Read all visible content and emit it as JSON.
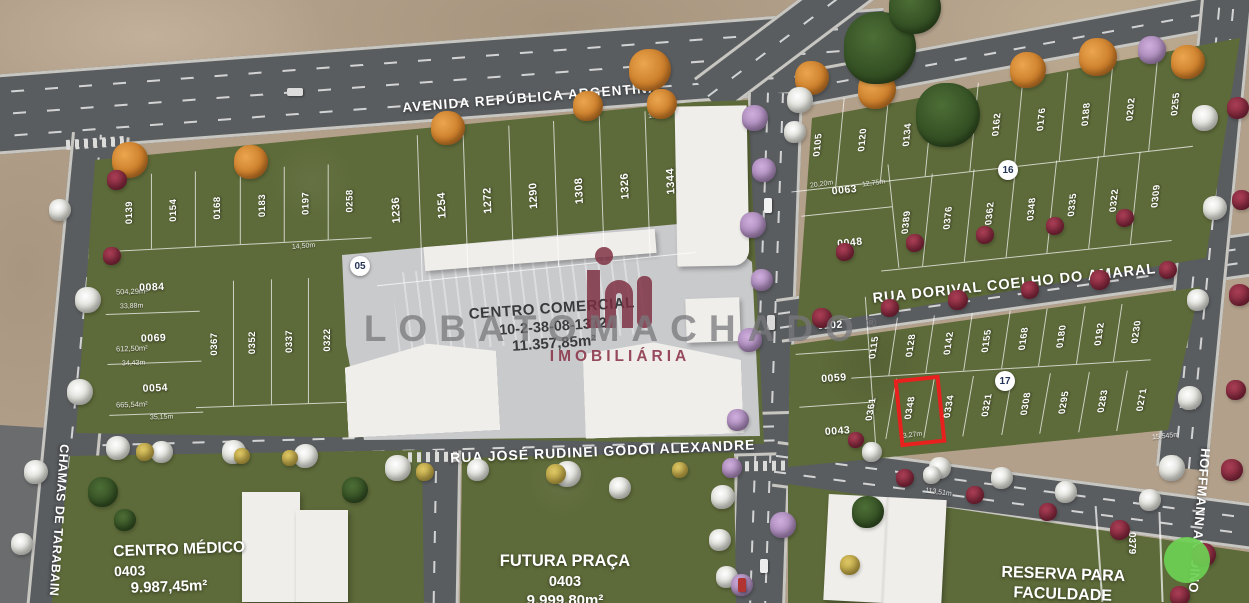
{
  "map": {
    "streets": {
      "avenida": "AVENIDA REPÚBLICA ARGENTINA",
      "rua_dorival": "RUA DORIVAL COELHO DO AMARAL",
      "rua_jose": "RUA JOSÉ RUDINEI GODOI ALEXANDRE",
      "rua_left_vertical": "CHAMAS DE TARABAIN",
      "rua_right_vertical": "HOFFMANN ANTOINO"
    },
    "markers": [
      "05",
      "16",
      "17"
    ],
    "areas": {
      "centro_comercial": {
        "title": "CENTRO COMERCIAL",
        "code": "10-2-38-08-1372",
        "area": "11.357,85m²"
      },
      "centro_medico": {
        "title": "CENTRO MÉDICO",
        "code": "0403",
        "area": "9.987,45m²"
      },
      "futura_praca": {
        "title": "FUTURA PRAÇA",
        "code": "0403",
        "area": "9.999,80m²"
      },
      "reserva_faculdade": {
        "title_line1": "RESERVA PARA",
        "title_line2": "FACULDADE"
      }
    },
    "lots": {
      "nw_top_row": [
        "0139",
        "0154",
        "0168",
        "0183",
        "0197",
        "0258"
      ],
      "avenue_row": [
        "1236",
        "1254",
        "1272",
        "1290",
        "1308",
        "1326",
        "1344"
      ],
      "west_column": [
        "0084",
        "0069",
        "0054"
      ],
      "west_inner_row": [
        "0367",
        "0352",
        "0337",
        "0322"
      ],
      "ne_top_row": [
        "0105",
        "0120",
        "0134",
        "0148",
        "0162",
        "0176",
        "0188",
        "0202",
        "0255"
      ],
      "ne_left_column": [
        "0063",
        "0048"
      ],
      "ne_bottom_row": [
        "0389",
        "0376",
        "0362",
        "0348",
        "0335",
        "0322",
        "0309"
      ],
      "se_left_column": [
        "0102",
        "0059",
        "0043"
      ],
      "se_top_row": [
        "0115",
        "0128",
        "0142",
        "0155",
        "0168",
        "0180",
        "0192",
        "0230"
      ],
      "se_bottom_row": [
        "0361",
        "0348",
        "0334",
        "0321",
        "0308",
        "0295",
        "0283",
        "0271"
      ],
      "reserva_lot": "0379",
      "highlighted_lot": "0348"
    },
    "lot_details": {
      "west_column_areas": [
        "504,29m²",
        "612,50m²",
        "665,54m²"
      ]
    },
    "dimensions": [
      "113,51m",
      "35,15m",
      "33,88m",
      "34,43m",
      "20,20m",
      "13,27m",
      "15,545m",
      "18,00m",
      "14,50m",
      "12,75m"
    ],
    "watermark": {
      "brand": "LOBATOMACHADO",
      "reg": "®",
      "subtitle": "IMOBILIÁRIA"
    },
    "colors": {
      "highlight_red": "#e8201e",
      "pin_green": "#6fcf53",
      "brand_maroon": "#7d2d3f",
      "grass": "#5d6a39"
    }
  }
}
